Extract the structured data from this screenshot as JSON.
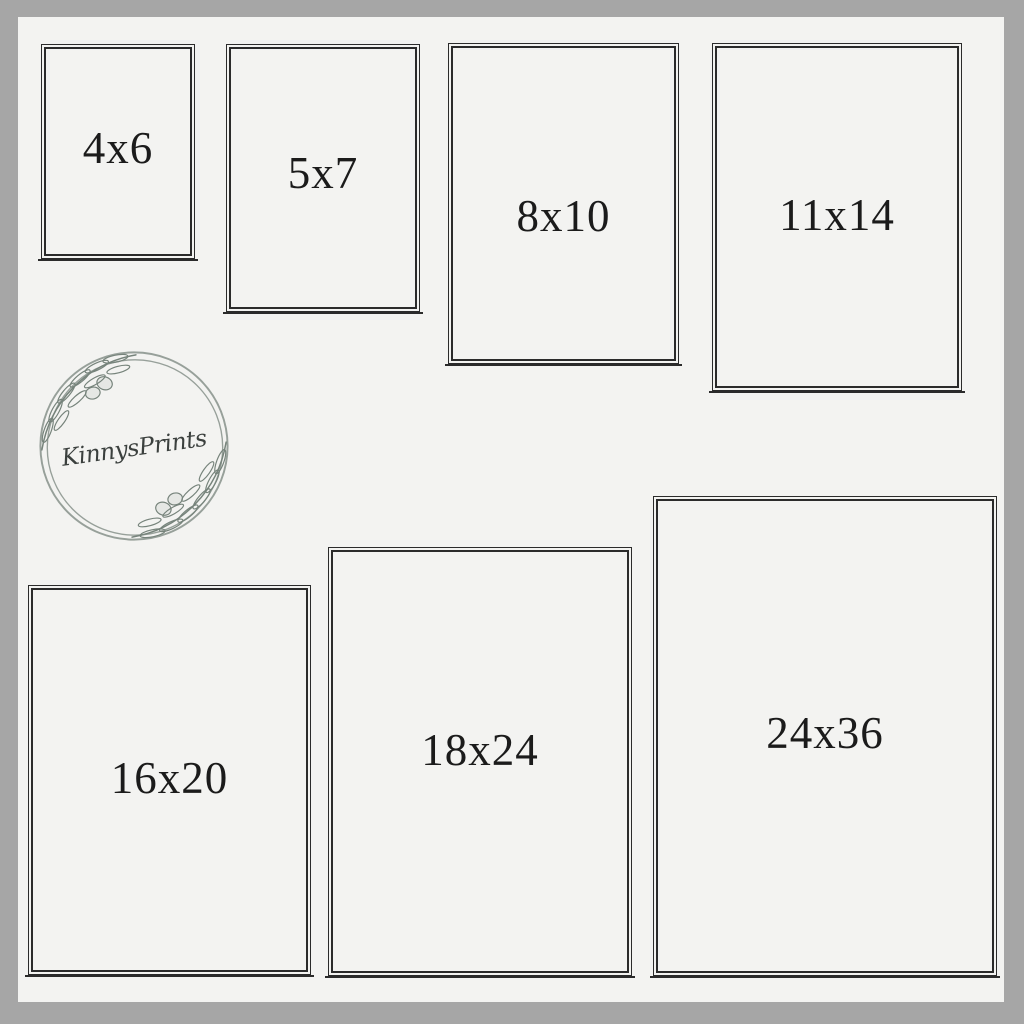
{
  "page": {
    "background_color": "#f3f3f1",
    "border_color": "#a6a6a6",
    "line_color": "#2b2b2b",
    "label_color": "#1b1b1b"
  },
  "logo": {
    "brand": "KinnysPrints",
    "ring_color": "#97a09a",
    "branch_color": "#76837b",
    "text_color": "#3b403e"
  },
  "frames": [
    {
      "label": "4x6"
    },
    {
      "label": "5x7"
    },
    {
      "label": "8x10"
    },
    {
      "label": "11x14"
    },
    {
      "label": "16x20"
    },
    {
      "label": "18x24"
    },
    {
      "label": "24x36"
    }
  ]
}
